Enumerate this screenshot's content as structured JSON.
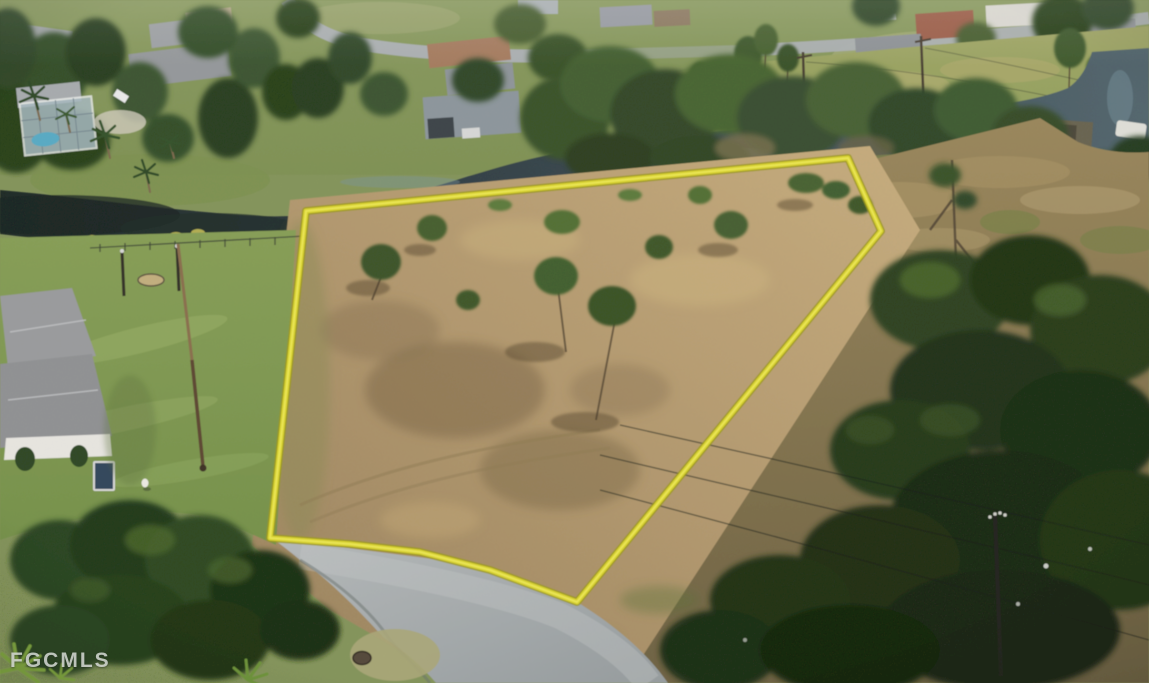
{
  "watermark": {
    "text": "FGCMLS"
  },
  "scene": {
    "caption": "Aerial drone photo of a cleared vacant land parcel outlined in yellow, bordered by a freshwater canal, residential homes, green lawns and a curved asphalt street",
    "boundary": {
      "path": "M306,211 L848,158 L881,231 L577,602 L490,570 L420,552 L350,544 L270,538 Z",
      "color": "#d9d32f"
    },
    "colors": {
      "boundary_yellow": "#d9d32f",
      "lot_dirt": "#b59a72",
      "canal_water": "#35423f",
      "street_gray": "#a8adaf",
      "lawn_green": "#849b55",
      "dense_tree_green": "#24361c"
    }
  }
}
